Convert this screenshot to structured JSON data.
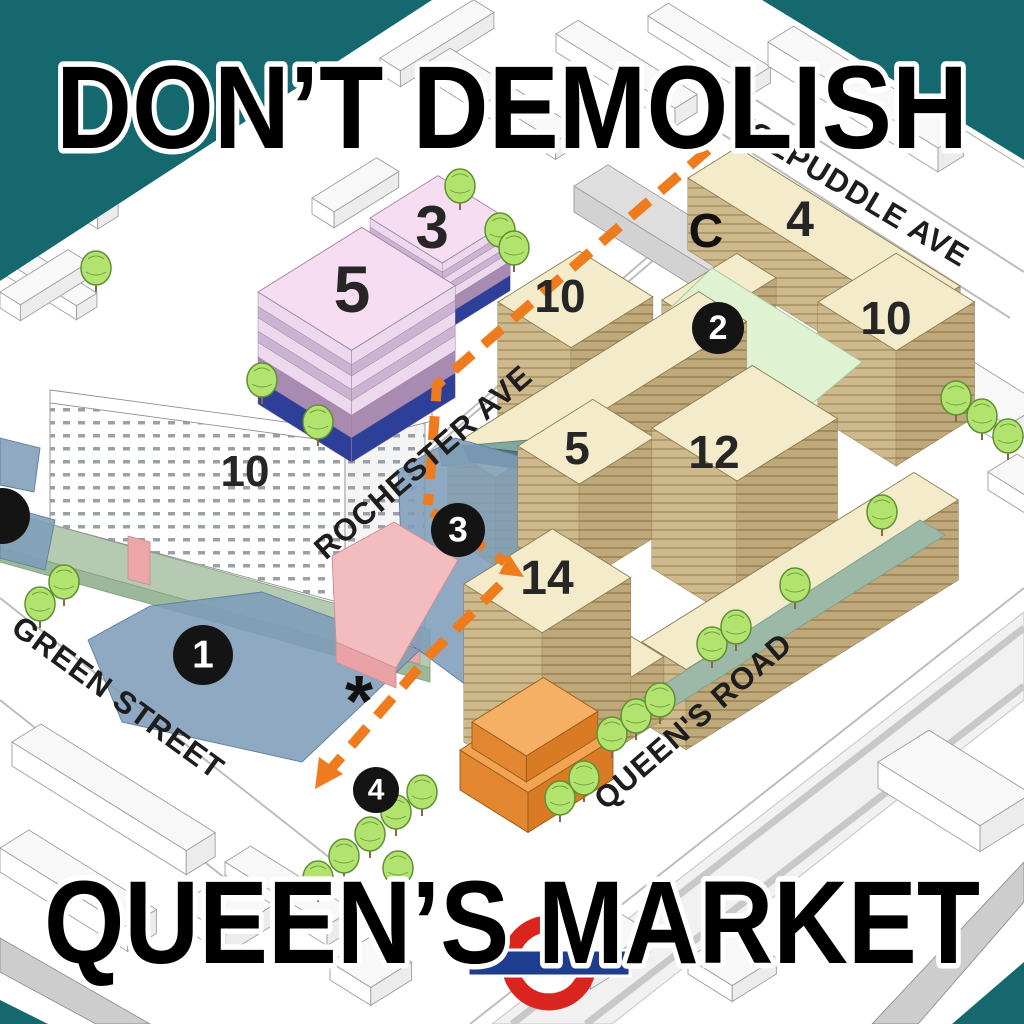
{
  "poster": {
    "title_top": "DON’T DEMOLISH",
    "title_bottom": "QUEEN’S MARKET"
  },
  "streets": [
    {
      "id": "rochester",
      "name": "ROCHESTER AVE"
    },
    {
      "id": "tolpuddle",
      "name": "TOLPUDDLE AVE"
    },
    {
      "id": "green",
      "name": "GREEN STREET"
    },
    {
      "id": "queens",
      "name": "QUEEN'S ROAD"
    }
  ],
  "building_labels": [
    {
      "id": "pink-3",
      "text": "3"
    },
    {
      "id": "pink-5",
      "text": "5"
    },
    {
      "id": "white-10",
      "text": "10"
    },
    {
      "id": "tan-10-west",
      "text": "10"
    },
    {
      "id": "tan-4",
      "text": "4"
    },
    {
      "id": "tan-10-east",
      "text": "10"
    },
    {
      "id": "tan-5",
      "text": "5"
    },
    {
      "id": "tan-12",
      "text": "12"
    },
    {
      "id": "tan-14",
      "text": "14"
    }
  ],
  "markers": [
    {
      "id": "marker-1",
      "number": "1"
    },
    {
      "id": "marker-2",
      "number": "2"
    },
    {
      "id": "marker-3",
      "number": "3"
    },
    {
      "id": "marker-4",
      "number": "4"
    },
    {
      "id": "marker-edge",
      "number": ""
    }
  ],
  "annotations": [
    {
      "id": "label-c",
      "text": "C"
    },
    {
      "id": "asterisk",
      "text": "*"
    }
  ],
  "logo": {
    "name": "underground-roundel",
    "ring_color": "#d9251d",
    "bar_color": "#1e3d8f"
  },
  "colors": {
    "teal_background": "#15696e",
    "map_ground": "#ffffff",
    "route_orange": "#ee7c1f",
    "tan_roof": "#f4ebcb",
    "tan_wall": "#cdb98c",
    "courtyard_green": "#dff2d2",
    "pink_roof": "#f6ddf2",
    "pink_wall_light": "#ecd9ee",
    "pink_wall_dark": "#a98bb1",
    "blue_base": "#2e3f9a",
    "market_roof_blue": "#7e9db8",
    "red_block": "#f3bcbe",
    "orange_block": "#e2862f",
    "tree_green": "#b2e36e",
    "marker_black": "#141414",
    "label_ink": "#1d1d1d"
  }
}
